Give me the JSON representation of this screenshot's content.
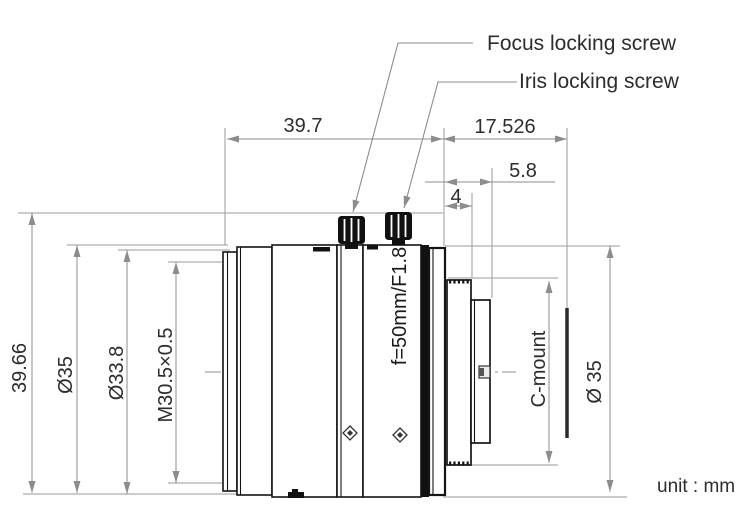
{
  "labels": {
    "focus_screw": "Focus locking screw",
    "iris_screw": "Iris locking screw",
    "unit_note": "unit : mm"
  },
  "lens": {
    "spec_marking": "f=50mm/F1.8"
  },
  "dimensions": {
    "front_length": "39.7",
    "flange_focal_distance": "17.526",
    "rear_length_major": "5.8",
    "rear_length_minor": "4",
    "overall_height": "39.66",
    "outer_diameter_left": "Ø35",
    "front_ring_diameter": "Ø33.8",
    "filter_thread": "M30.5×0.5",
    "mount_type": "C-mount",
    "outer_diameter_right": "Ø 35"
  },
  "colors": {
    "background": "#ffffff",
    "dimension_line": "#8c8c8c",
    "text": "#2d2d2d",
    "outline": "#141414"
  }
}
